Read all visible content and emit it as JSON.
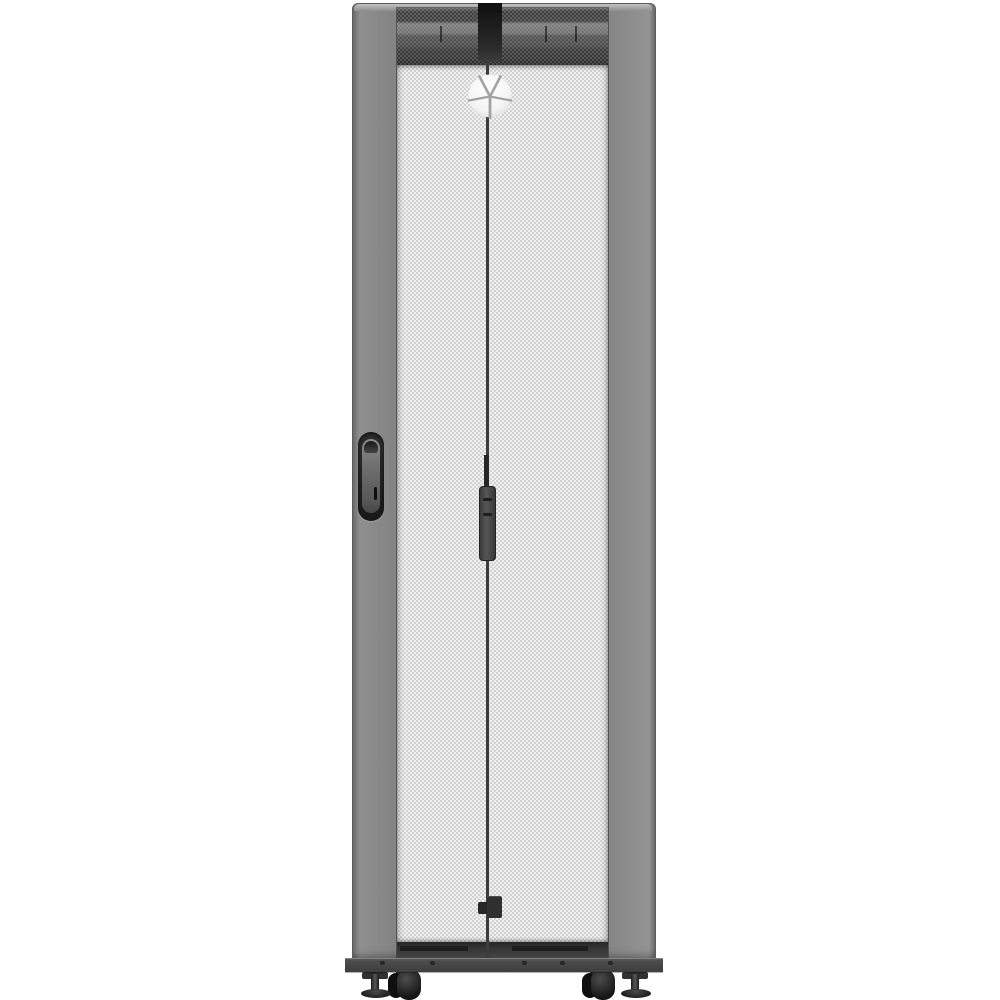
{
  "scene": {
    "type": "product-photo",
    "background": "#ffffff",
    "description": "Front view of a tall gray-and-black server rack cabinet (Vertiv VR series style) with a split perforated mesh front door, white hex-perforated panels, dark vented top and bottom rails, recessed key-lock handle on the left frame, vertical center latch on the door seam, a white Vertiv emblem near the top, and a base plinth with two casters and two leveling feet, photographed on a plain white background"
  },
  "labels": {
    "rack": "Server rack cabinet, front view",
    "mesh_door": "Split perforated front door",
    "logo": "Vertiv bird emblem logo",
    "left_handle": "Recessed swing handle with key lock",
    "center_latch": "Center door latch handle",
    "bottom_latch": "Bottom door latch bracket",
    "base": "Base plinth with bolts",
    "left_caster": "Front-left caster wheel",
    "right_caster": "Front-right caster wheel",
    "left_foot": "Front-left leveling foot",
    "right_foot": "Front-right leveling foot"
  },
  "colors": {
    "scene_bg": "#ffffff",
    "frame": "#838383",
    "frame_dark": "#5c5c5c",
    "cap_light": "#c2c2c2",
    "mesh_bg": "#fdfdfd",
    "mesh_web": "#d2d2d2",
    "band_dark1": "#383838",
    "band_light": "#6e6e6e",
    "band_dark2": "#454545",
    "band_darkest": "#1f1f1f",
    "rail_bottom": "#353535",
    "seam": "#3c3c3c",
    "hardware_mid": "#565656",
    "base": "#3e3e3e",
    "wheel": "#161616",
    "logo_white": "#fbfbfb",
    "logo_cut": "#a3a3a3"
  }
}
